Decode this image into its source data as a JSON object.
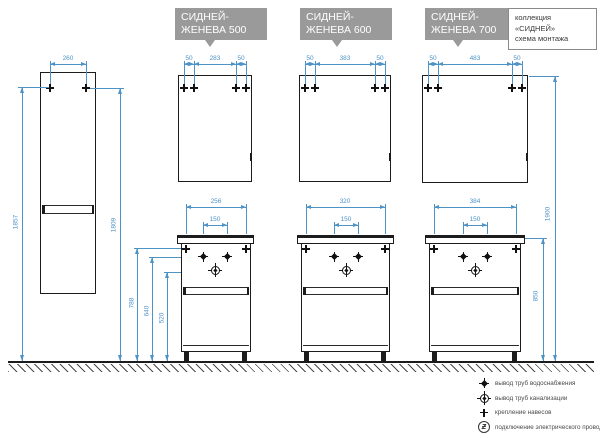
{
  "diagram": {
    "tall_cabinet": {
      "width": "260",
      "height_left": "1857",
      "height_right": "1809"
    },
    "install_heights": {
      "hanger": "788",
      "water": "640",
      "drain": "520"
    },
    "right_heights": {
      "base_top": "850",
      "mirror_top": "1900"
    },
    "sets": [
      {
        "callout_line1": "СИДНЕЙ-",
        "callout_line2": "ЖЕНЕВА 500",
        "mirror_left": "50",
        "mirror_span": "283",
        "mirror_right": "50",
        "base_width": "256",
        "tap_span": "150"
      },
      {
        "callout_line1": "СИДНЕЙ-",
        "callout_line2": "ЖЕНЕВА 600",
        "mirror_left": "50",
        "mirror_span": "383",
        "mirror_right": "50",
        "base_width": "320",
        "tap_span": "150"
      },
      {
        "callout_line1": "СИДНЕЙ-",
        "callout_line2": "ЖЕНЕВА 700",
        "mirror_left": "50",
        "mirror_span": "483",
        "mirror_right": "50",
        "base_width": "384",
        "tap_span": "150"
      }
    ]
  },
  "info_box": {
    "line1": "коллекция",
    "line2": "«СИДНЕЙ»",
    "line3": "схема монтажа"
  },
  "legend": {
    "electric_glyph": "ƶ",
    "items": [
      {
        "icon": "water-supply-mark-icon",
        "label": "вывод труб водоснабжения"
      },
      {
        "icon": "drain-mark-icon",
        "label": "вывод труб канализации"
      },
      {
        "icon": "hanger-mount-mark-icon",
        "label": "крепление навесов"
      },
      {
        "icon": "electric-connection-icon",
        "label": "подключение электрического провода"
      }
    ]
  },
  "colors": {
    "dimension": "#4e93c6",
    "drawing": "#1c1c1c",
    "callout_bg": "#9a9a9a"
  }
}
